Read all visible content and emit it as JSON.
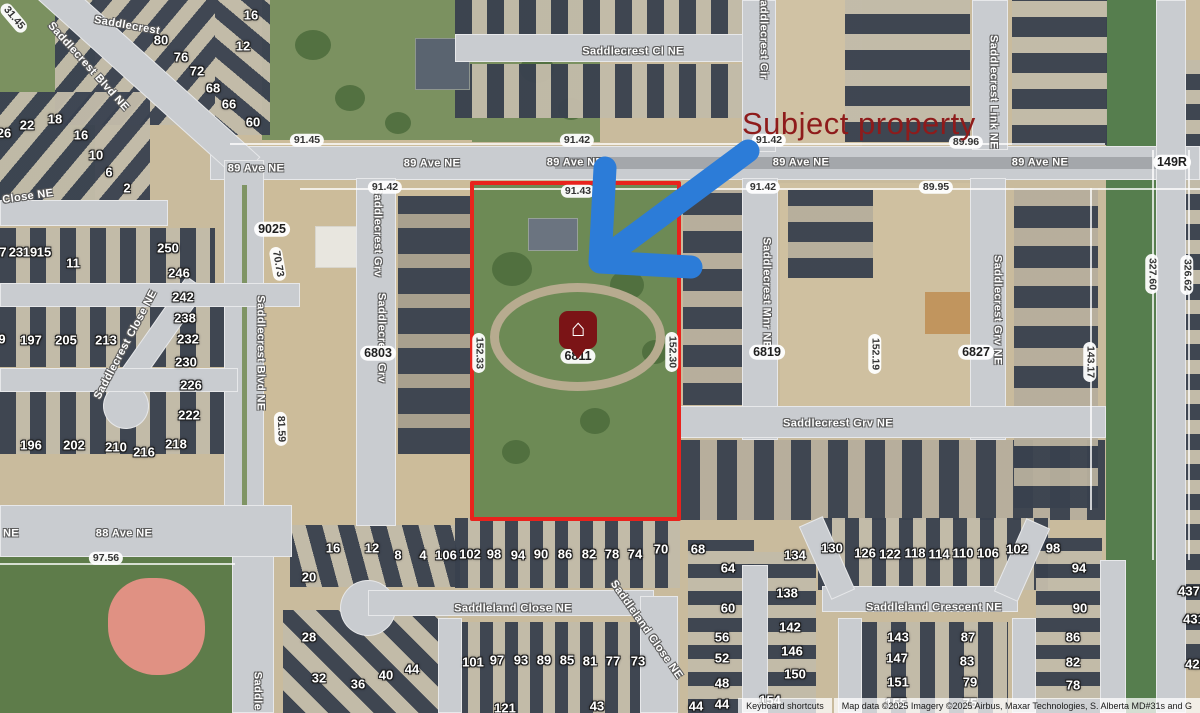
{
  "annotation": {
    "subject_property_text": "Subject property",
    "pin_address": "6811",
    "colors": {
      "label_red": "#8e1b1b",
      "outline_red": "#e8231d",
      "arrow_blue": "#2c7cd8",
      "pin_red": "#7b1416"
    }
  },
  "attribution": {
    "keyboard_shortcuts": "Keyboard shortcuts",
    "map_data": "Map data ©2025 Imagery ©2025 Airbus, Maxar Technologies, S. Alberta MD#31s and G"
  },
  "streets": [
    {
      "text": "Saddlecrest",
      "x": 127,
      "y": 26,
      "rot": 10
    },
    {
      "text": "Saddlecrest Blvd NE",
      "x": 88,
      "y": 67,
      "rot": 48
    },
    {
      "text": "Saddlecrest Cl NE",
      "x": 633,
      "y": 52,
      "rot": 0
    },
    {
      "text": "Saddlecrest Cir",
      "x": 763,
      "y": 36,
      "rot": 90
    },
    {
      "text": "Saddlecrest Link NE",
      "x": 993,
      "y": 92,
      "rot": 90
    },
    {
      "text": "89 Ave NE",
      "x": 256,
      "y": 169,
      "rot": 0
    },
    {
      "text": "89 Ave NE",
      "x": 432,
      "y": 164,
      "rot": 0
    },
    {
      "text": "89 Ave NE",
      "x": 575,
      "y": 163,
      "rot": 0
    },
    {
      "text": "89 Ave NE",
      "x": 801,
      "y": 163,
      "rot": 0
    },
    {
      "text": "89 Ave NE",
      "x": 1040,
      "y": 163,
      "rot": 0
    },
    {
      "text": "Saddlecrest Blvd NE",
      "x": 260,
      "y": 353,
      "rot": 90
    },
    {
      "text": "Saddlecrest Grv",
      "x": 377,
      "y": 232,
      "rot": 90
    },
    {
      "text": "Saddlecrest Grv",
      "x": 381,
      "y": 338,
      "rot": 90
    },
    {
      "text": "Saddlecrest Mnr NE",
      "x": 766,
      "y": 293,
      "rot": 90
    },
    {
      "text": "Saddlecrest Grv NE",
      "x": 997,
      "y": 310,
      "rot": 90
    },
    {
      "text": "Saddlecrest Grv NE",
      "x": 838,
      "y": 424,
      "rot": 0
    },
    {
      "text": "Saddlecrest Close NE",
      "x": 126,
      "y": 345,
      "rot": -62
    },
    {
      "text": "Close NE",
      "x": 28,
      "y": 197,
      "rot": -8
    },
    {
      "text": "88 Ave NE",
      "x": 124,
      "y": 534,
      "rot": 0
    },
    {
      "text": "NE",
      "x": 11,
      "y": 534,
      "rot": 0
    },
    {
      "text": "Saddleland Close NE",
      "x": 513,
      "y": 609,
      "rot": 0
    },
    {
      "text": "Saddleland Close NE",
      "x": 646,
      "y": 630,
      "rot": 55
    },
    {
      "text": "Saddleland Crescent NE",
      "x": 934,
      "y": 608,
      "rot": 0
    },
    {
      "text": "Saddle",
      "x": 257,
      "y": 691,
      "rot": 90
    }
  ],
  "dimensions": [
    {
      "text": "31.45",
      "x": 14,
      "y": 18,
      "rot": 50
    },
    {
      "text": "91.45",
      "x": 307,
      "y": 140,
      "rot": 0
    },
    {
      "text": "91.42",
      "x": 577,
      "y": 140,
      "rot": 0
    },
    {
      "text": "91.42",
      "x": 769,
      "y": 140,
      "rot": 0
    },
    {
      "text": "89.96",
      "x": 966,
      "y": 142,
      "rot": 0
    },
    {
      "text": "91.42",
      "x": 385,
      "y": 187,
      "rot": 0
    },
    {
      "text": "91.43",
      "x": 578,
      "y": 191,
      "rot": 0
    },
    {
      "text": "91.42",
      "x": 763,
      "y": 187,
      "rot": 0
    },
    {
      "text": "89.95",
      "x": 936,
      "y": 187,
      "rot": 0
    },
    {
      "text": "70.73",
      "x": 278,
      "y": 264,
      "rot": 80
    },
    {
      "text": "81.59",
      "x": 281,
      "y": 429,
      "rot": 88
    },
    {
      "text": "152.33",
      "x": 479,
      "y": 353,
      "rot": 90
    },
    {
      "text": "152.30",
      "x": 672,
      "y": 352,
      "rot": 90
    },
    {
      "text": "152.19",
      "x": 875,
      "y": 354,
      "rot": 90
    },
    {
      "text": "143.17",
      "x": 1090,
      "y": 362,
      "rot": 90
    },
    {
      "text": "327.60",
      "x": 1152,
      "y": 274,
      "rot": 90
    },
    {
      "text": "326.62",
      "x": 1187,
      "y": 275,
      "rot": 90
    },
    {
      "text": "97.56",
      "x": 106,
      "y": 558,
      "rot": 0
    }
  ],
  "addresses": [
    {
      "text": "9025",
      "x": 272,
      "y": 229
    },
    {
      "text": "6803",
      "x": 378,
      "y": 353
    },
    {
      "text": "6811",
      "x": 578,
      "y": 356
    },
    {
      "text": "6819",
      "x": 767,
      "y": 352
    },
    {
      "text": "6827",
      "x": 976,
      "y": 352
    },
    {
      "text": "149R",
      "x": 1172,
      "y": 162
    }
  ],
  "lots": [
    {
      "n": "16",
      "x": 251,
      "y": 15
    },
    {
      "n": "12",
      "x": 243,
      "y": 46
    },
    {
      "n": "80",
      "x": 161,
      "y": 40
    },
    {
      "n": "76",
      "x": 181,
      "y": 57
    },
    {
      "n": "72",
      "x": 197,
      "y": 71
    },
    {
      "n": "68",
      "x": 213,
      "y": 88
    },
    {
      "n": "66",
      "x": 229,
      "y": 104
    },
    {
      "n": "60",
      "x": 253,
      "y": 122
    },
    {
      "n": "26",
      "x": 4,
      "y": 133
    },
    {
      "n": "22",
      "x": 27,
      "y": 125
    },
    {
      "n": "18",
      "x": 55,
      "y": 119
    },
    {
      "n": "16",
      "x": 81,
      "y": 135
    },
    {
      "n": "10",
      "x": 96,
      "y": 155
    },
    {
      "n": "6",
      "x": 109,
      "y": 172
    },
    {
      "n": "2",
      "x": 127,
      "y": 188
    },
    {
      "n": "7",
      "x": 3,
      "y": 252
    },
    {
      "n": "23",
      "x": 16,
      "y": 252
    },
    {
      "n": "19",
      "x": 30,
      "y": 252
    },
    {
      "n": "15",
      "x": 44,
      "y": 252
    },
    {
      "n": "11",
      "x": 73,
      "y": 263
    },
    {
      "n": "9",
      "x": 2,
      "y": 339
    },
    {
      "n": "197",
      "x": 31,
      "y": 340
    },
    {
      "n": "205",
      "x": 66,
      "y": 340
    },
    {
      "n": "213",
      "x": 106,
      "y": 340
    },
    {
      "n": "250",
      "x": 168,
      "y": 248
    },
    {
      "n": "246",
      "x": 179,
      "y": 273
    },
    {
      "n": "242",
      "x": 183,
      "y": 297
    },
    {
      "n": "238",
      "x": 185,
      "y": 318
    },
    {
      "n": "232",
      "x": 188,
      "y": 339
    },
    {
      "n": "230",
      "x": 186,
      "y": 362
    },
    {
      "n": "226",
      "x": 191,
      "y": 385
    },
    {
      "n": "222",
      "x": 189,
      "y": 415
    },
    {
      "n": "218",
      "x": 176,
      "y": 444
    },
    {
      "n": "216",
      "x": 144,
      "y": 452
    },
    {
      "n": "210",
      "x": 116,
      "y": 447
    },
    {
      "n": "202",
      "x": 74,
      "y": 445
    },
    {
      "n": "196",
      "x": 31,
      "y": 445
    },
    {
      "n": "16",
      "x": 333,
      "y": 548
    },
    {
      "n": "20",
      "x": 309,
      "y": 577
    },
    {
      "n": "12",
      "x": 372,
      "y": 548
    },
    {
      "n": "8",
      "x": 398,
      "y": 555
    },
    {
      "n": "4",
      "x": 423,
      "y": 555
    },
    {
      "n": "28",
      "x": 309,
      "y": 637
    },
    {
      "n": "32",
      "x": 319,
      "y": 678
    },
    {
      "n": "36",
      "x": 358,
      "y": 684
    },
    {
      "n": "40",
      "x": 386,
      "y": 675
    },
    {
      "n": "44",
      "x": 412,
      "y": 669
    },
    {
      "n": "106",
      "x": 446,
      "y": 555
    },
    {
      "n": "102",
      "x": 470,
      "y": 554
    },
    {
      "n": "98",
      "x": 494,
      "y": 554
    },
    {
      "n": "94",
      "x": 518,
      "y": 555
    },
    {
      "n": "90",
      "x": 541,
      "y": 554
    },
    {
      "n": "86",
      "x": 565,
      "y": 554
    },
    {
      "n": "82",
      "x": 589,
      "y": 554
    },
    {
      "n": "78",
      "x": 612,
      "y": 554
    },
    {
      "n": "74",
      "x": 635,
      "y": 554
    },
    {
      "n": "70",
      "x": 661,
      "y": 549
    },
    {
      "n": "68",
      "x": 698,
      "y": 549
    },
    {
      "n": "101",
      "x": 473,
      "y": 662
    },
    {
      "n": "97",
      "x": 497,
      "y": 660
    },
    {
      "n": "93",
      "x": 521,
      "y": 660
    },
    {
      "n": "89",
      "x": 544,
      "y": 660
    },
    {
      "n": "85",
      "x": 567,
      "y": 660
    },
    {
      "n": "81",
      "x": 590,
      "y": 661
    },
    {
      "n": "77",
      "x": 613,
      "y": 661
    },
    {
      "n": "73",
      "x": 638,
      "y": 661
    },
    {
      "n": "121",
      "x": 505,
      "y": 708
    },
    {
      "n": "43",
      "x": 597,
      "y": 706
    },
    {
      "n": "44",
      "x": 696,
      "y": 706
    },
    {
      "n": "64",
      "x": 728,
      "y": 568
    },
    {
      "n": "60",
      "x": 728,
      "y": 608
    },
    {
      "n": "56",
      "x": 722,
      "y": 637
    },
    {
      "n": "52",
      "x": 722,
      "y": 658
    },
    {
      "n": "48",
      "x": 722,
      "y": 683
    },
    {
      "n": "44",
      "x": 722,
      "y": 704
    },
    {
      "n": "134",
      "x": 795,
      "y": 555
    },
    {
      "n": "138",
      "x": 787,
      "y": 593
    },
    {
      "n": "142",
      "x": 790,
      "y": 627
    },
    {
      "n": "146",
      "x": 792,
      "y": 651
    },
    {
      "n": "150",
      "x": 795,
      "y": 674
    },
    {
      "n": "154",
      "x": 770,
      "y": 700
    },
    {
      "n": "130",
      "x": 832,
      "y": 548
    },
    {
      "n": "126",
      "x": 865,
      "y": 553
    },
    {
      "n": "122",
      "x": 890,
      "y": 554
    },
    {
      "n": "118",
      "x": 915,
      "y": 553
    },
    {
      "n": "114",
      "x": 939,
      "y": 554
    },
    {
      "n": "110",
      "x": 963,
      "y": 553
    },
    {
      "n": "106",
      "x": 988,
      "y": 553
    },
    {
      "n": "102",
      "x": 1017,
      "y": 549
    },
    {
      "n": "98",
      "x": 1053,
      "y": 548
    },
    {
      "n": "94",
      "x": 1079,
      "y": 568
    },
    {
      "n": "90",
      "x": 1080,
      "y": 608
    },
    {
      "n": "86",
      "x": 1073,
      "y": 637
    },
    {
      "n": "82",
      "x": 1073,
      "y": 662
    },
    {
      "n": "78",
      "x": 1073,
      "y": 685
    },
    {
      "n": "143",
      "x": 898,
      "y": 637
    },
    {
      "n": "147",
      "x": 897,
      "y": 658
    },
    {
      "n": "151",
      "x": 898,
      "y": 682
    },
    {
      "n": "155",
      "x": 896,
      "y": 703
    },
    {
      "n": "87",
      "x": 968,
      "y": 637
    },
    {
      "n": "83",
      "x": 967,
      "y": 661
    },
    {
      "n": "79",
      "x": 970,
      "y": 682
    },
    {
      "n": "75",
      "x": 970,
      "y": 703
    },
    {
      "n": "437",
      "x": 1189,
      "y": 591
    },
    {
      "n": "431",
      "x": 1194,
      "y": 619
    },
    {
      "n": "425",
      "x": 1196,
      "y": 664
    }
  ]
}
